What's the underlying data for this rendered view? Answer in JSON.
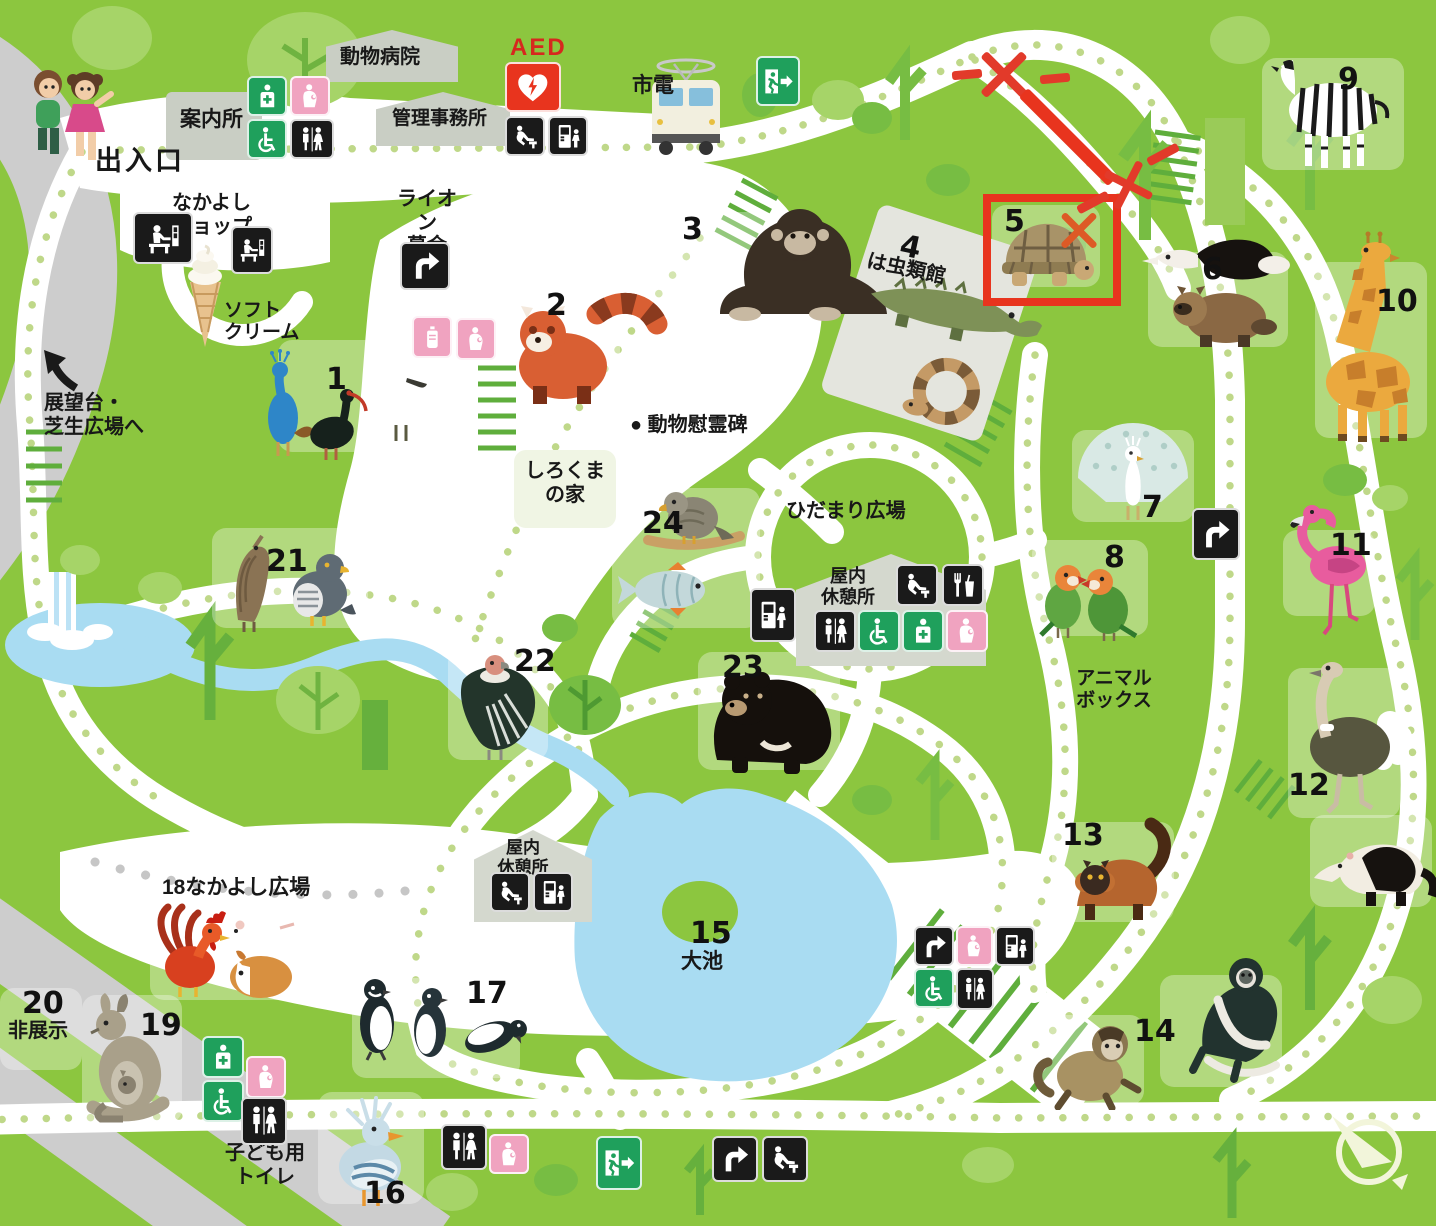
{
  "facilities": {
    "entrance": "出入口",
    "information": "案内所",
    "animal_hospital": "動物病院",
    "admin_office": "管理事務所",
    "aed": "AED",
    "tram": "市電",
    "nakayoshi_shop": "なかよし\nショップ",
    "soft_cream": "ソフト\nクリーム",
    "lion_fund": "ライオン\n募金",
    "lookout": "展望台・\n芝生広場へ",
    "polar_bear_house": "しろくま\nの家",
    "memorial": "● 動物慰霊碑",
    "hidamari_plaza": "ひだまり広場",
    "indoor_rest_1": "屋内\n休憩所",
    "indoor_rest_2": "屋内\n休憩所",
    "animal_box": "アニマル\nボックス",
    "reptile_house": "は虫類館",
    "big_pond": "大池",
    "nakayoshi_plaza": "18なかよし広場",
    "not_exhibit": "非展示",
    "kids_toilet": "子ども用\nトイレ"
  },
  "animals": [
    {
      "number": "1",
      "species": "indian-peafowl-ibis-spoonbill"
    },
    {
      "number": "2",
      "species": "red-panda"
    },
    {
      "number": "3",
      "species": "chimpanzee"
    },
    {
      "number": "4",
      "species": "reptile-house-crocodile-snake"
    },
    {
      "number": "5",
      "species": "giant-tortoise"
    },
    {
      "number": "6",
      "species": "anteater-raccoon-dog"
    },
    {
      "number": "7",
      "species": "white-peacock"
    },
    {
      "number": "8",
      "species": "lovebirds"
    },
    {
      "number": "9",
      "species": "zebra"
    },
    {
      "number": "10",
      "species": "giraffe"
    },
    {
      "number": "11",
      "species": "flamingo"
    },
    {
      "number": "12",
      "species": "ostrich-tamandua"
    },
    {
      "number": "13",
      "species": "red-lemur"
    },
    {
      "number": "14",
      "species": "capuchin-colobus-monkey"
    },
    {
      "number": "15",
      "species": "big-pond"
    },
    {
      "number": "16",
      "species": "kagu"
    },
    {
      "number": "17",
      "species": "humboldt-penguins"
    },
    {
      "number": "18",
      "species": "rooster-mouse-guinea-pig"
    },
    {
      "number": "19",
      "species": "wallaby"
    },
    {
      "number": "20",
      "species": "not-exhibited"
    },
    {
      "number": "21",
      "species": "bittern-goshawk"
    },
    {
      "number": "22",
      "species": "andean-condor"
    },
    {
      "number": "23",
      "species": "asian-black-bear"
    },
    {
      "number": "24",
      "species": "hawk-and-carp"
    }
  ],
  "icons": {
    "toilet": "restroom-icon",
    "wheelchair": "wheelchair-accessible-icon",
    "first_aid": "first-aid-icon",
    "nursing": "nursing-room-icon",
    "baby_bottle": "baby-bottle-icon",
    "fountain": "drinking-fountain-icon",
    "vending": "vending-machine-icon",
    "food": "food-stand-icon",
    "arrow": "direction-arrow-icon",
    "exit": "emergency-exit-icon",
    "shop": "kiosk-icon",
    "aed_heart": "aed-heart-icon",
    "compass": "compass-north-icon"
  },
  "annotations": {
    "highlighted_number": "5",
    "marks": "red-x-closed-route-and-highlight-box",
    "color": "#E8341E"
  },
  "colors": {
    "grass": "#8CC63F",
    "path": "#FFFFFF",
    "path_dot": "#BFD889",
    "road": "#CCCCCC",
    "water": "#A9DCF2",
    "tile": "#B1D87C",
    "sign_black": "#1A1A1A",
    "sign_green": "#1FA05C",
    "sign_pink": "#F0A3C0",
    "aed_red": "#E8341E",
    "tree_light": "#A6D468",
    "tree_dark": "#66B03D",
    "building": "#C9CEC4"
  }
}
